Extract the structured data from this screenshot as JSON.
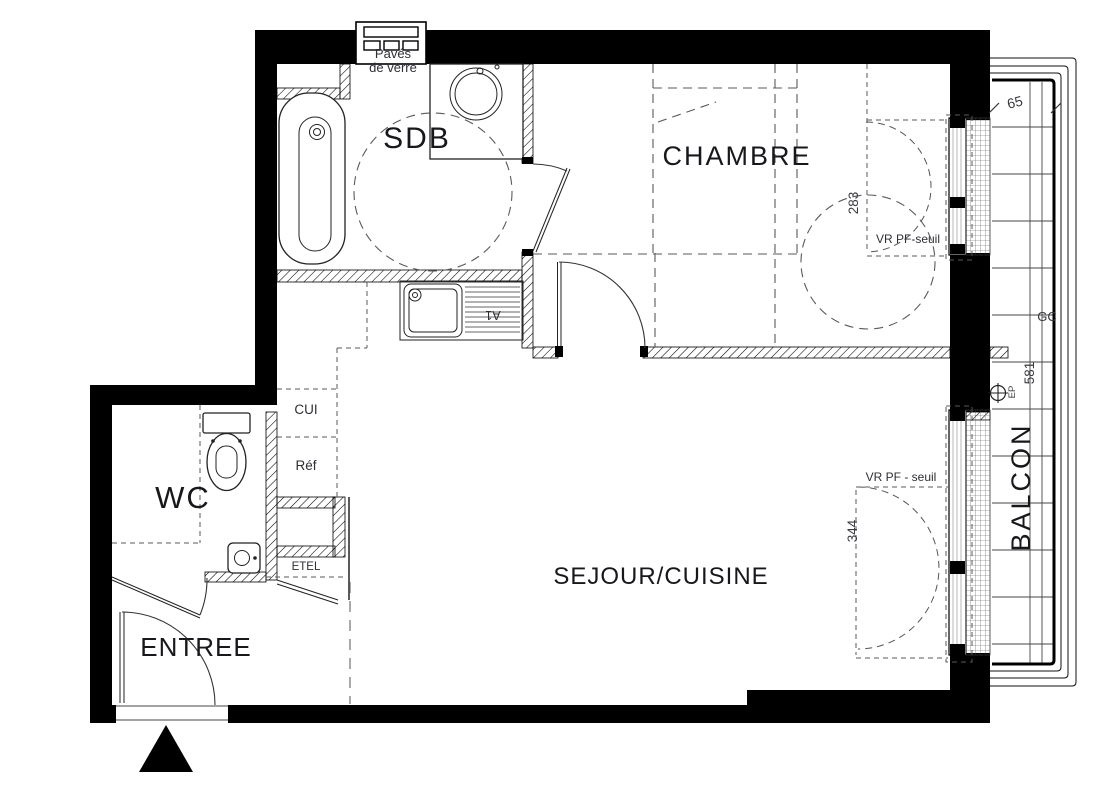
{
  "plan": {
    "rooms": {
      "sdb": "SDB",
      "chambre": "CHAMBRE",
      "wc": "WC",
      "sejour": "SEJOUR/CUISINE",
      "entree": "ENTREE",
      "balcon": "BALCON"
    },
    "annotations": {
      "paves_line1": "Pavés",
      "paves_line2": "de verre",
      "cui": "CUI",
      "ref": "Réf",
      "etel": "ETEL",
      "a1": "A1",
      "gc": "GC",
      "ep": "EP",
      "vr_chambre": "VR PF-seuil",
      "vr_sejour": "VR  PF - seuil"
    },
    "dimensions": {
      "balcon_depth": "65",
      "chambre_window": "283",
      "sejour_window": "344",
      "balcon_length": "581"
    },
    "colors": {
      "ink": "#000000",
      "label": "#17171c",
      "annotation": "#2e2e35",
      "dash": "#7d7d7d",
      "paper": "#ffffff"
    }
  }
}
